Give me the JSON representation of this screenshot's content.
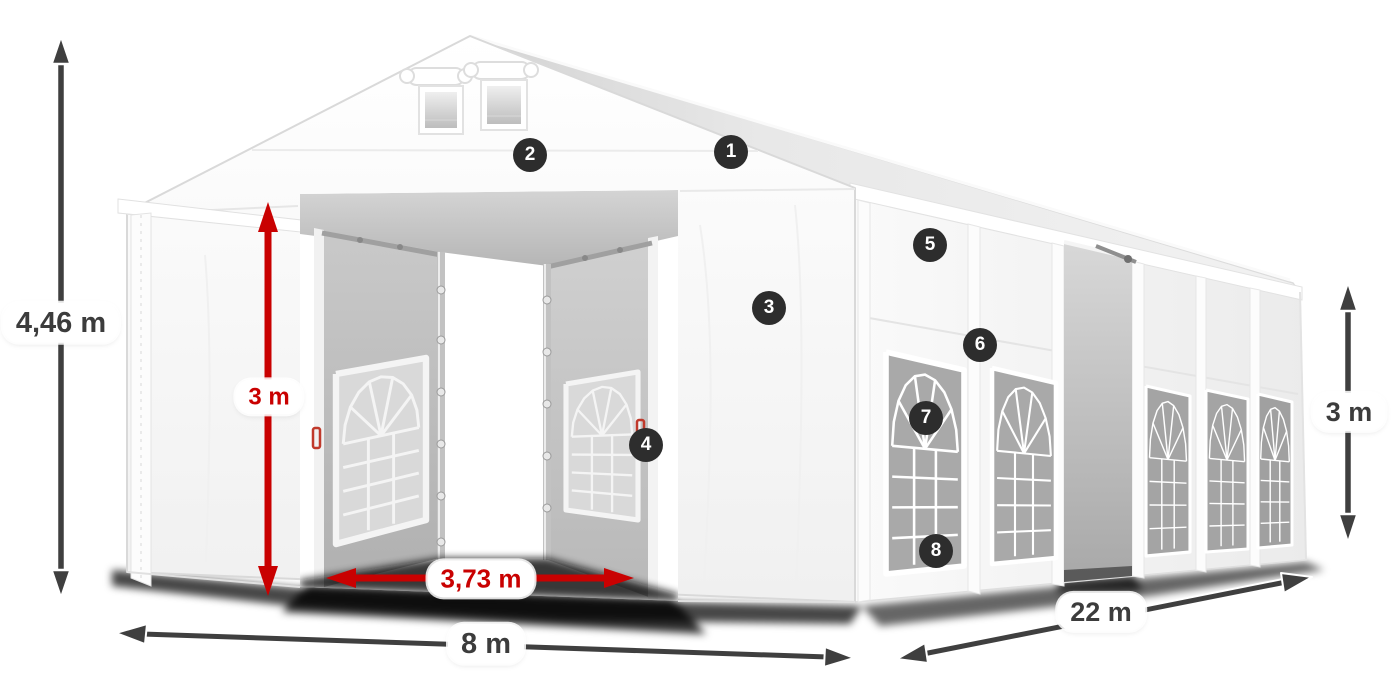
{
  "diagram": {
    "type": "product-dimension-diagram",
    "subject": "white marquee storage tent with open front doors, roof vents and windowed side wall",
    "dimensions": {
      "total_height": "4,46 m",
      "entrance_height": "3 m",
      "entrance_width": "3,73 m",
      "front_width": "8 m",
      "side_length": "22 m",
      "wall_height": "3 m"
    },
    "callouts": [
      {
        "number": "1"
      },
      {
        "number": "2"
      },
      {
        "number": "3"
      },
      {
        "number": "4"
      },
      {
        "number": "5"
      },
      {
        "number": "6"
      },
      {
        "number": "7"
      },
      {
        "number": "8"
      }
    ],
    "colors": {
      "dimension_red": "#c90101",
      "dimension_dark": "#3f3f3f",
      "badge_background": "#2d2d2d",
      "badge_text": "#ffffff",
      "label_background": "#ffffff",
      "tent_fabric": "#f7f7f7"
    }
  }
}
